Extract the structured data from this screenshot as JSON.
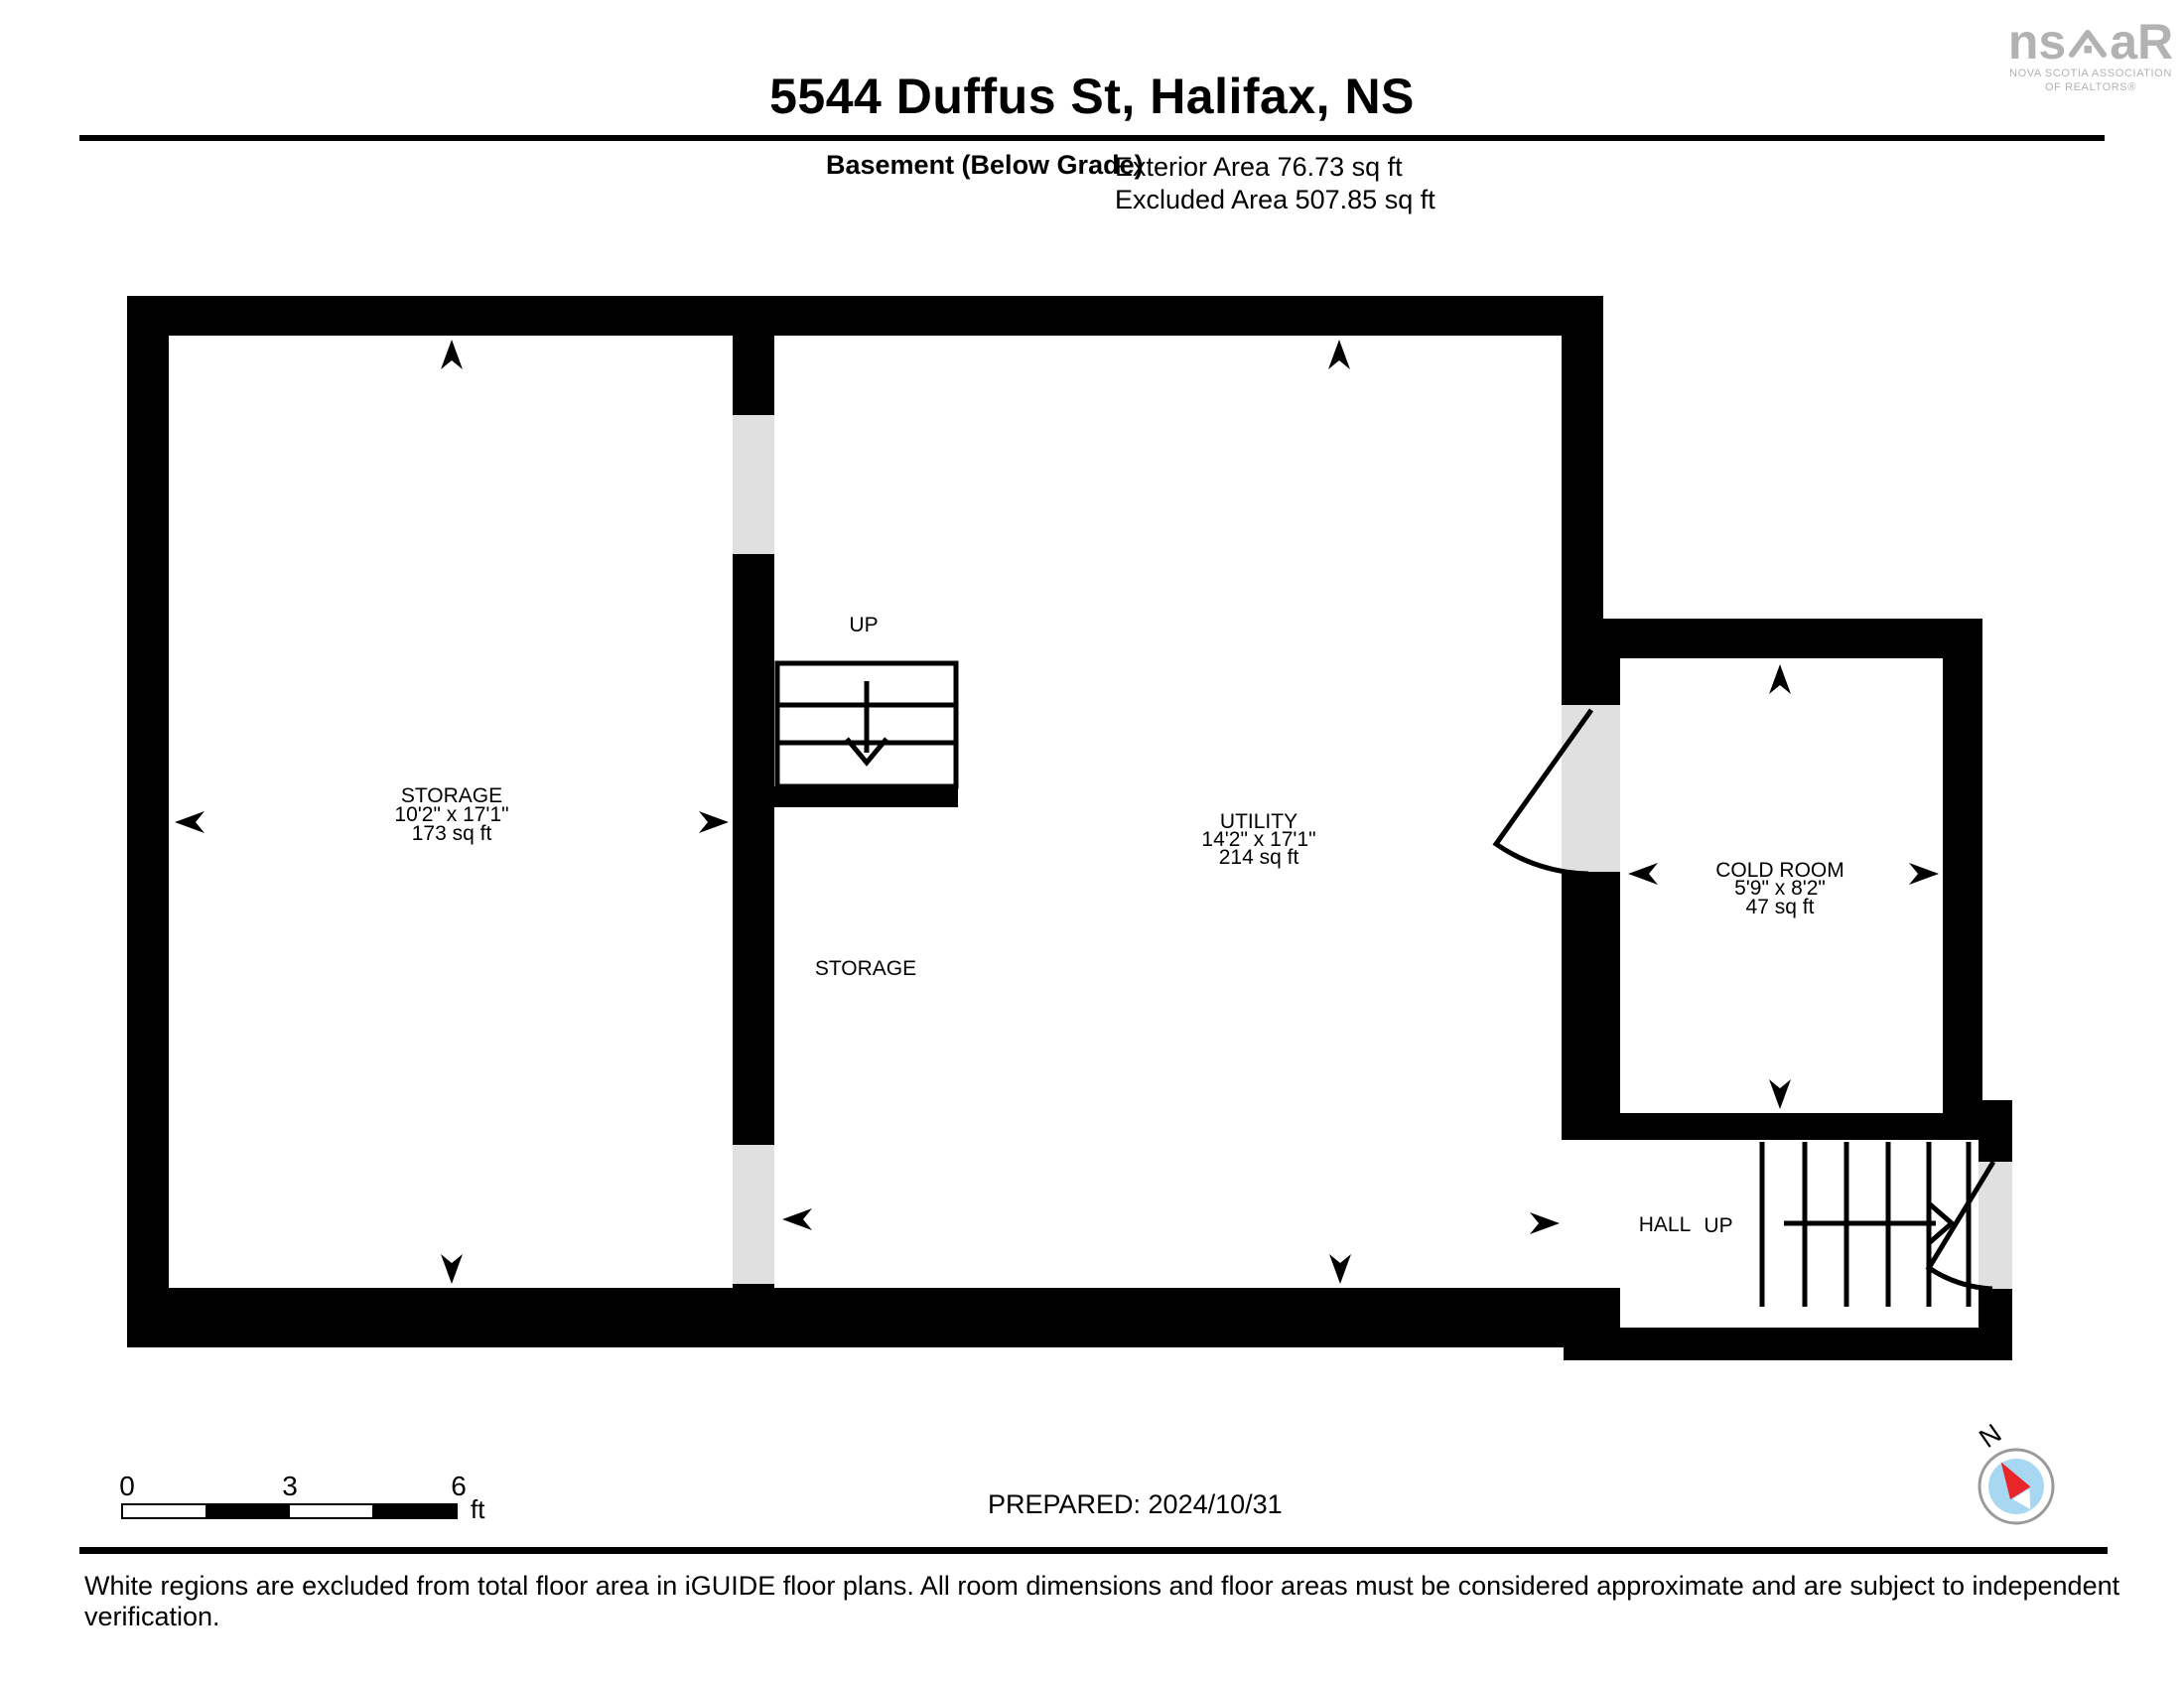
{
  "header": {
    "title": "5544 Duffus St, Halifax, NS",
    "floor_label": "Basement (Below Grade)",
    "exterior_area": "Exterior Area 76.73 sq ft",
    "excluded_area": "Excluded Area 507.85 sq ft"
  },
  "logo": {
    "brand_left": "ns",
    "brand_right": "aR",
    "tagline_line1": "NOVA SCOTIA ASSOCIATION",
    "tagline_line2": "OF REALTORS®",
    "color": "#b2b2b2"
  },
  "floor_plan": {
    "rooms": {
      "storage": {
        "name": "STORAGE",
        "dims": "10'2\" x 17'1\"",
        "area": "173 sq ft"
      },
      "utility": {
        "name": "UTILITY",
        "dims": "14'2\" x 17'1\"",
        "area": "214 sq ft"
      },
      "cold_room": {
        "name": "COLD ROOM",
        "dims": "5'9\" x 8'2\"",
        "area": "47 sq ft"
      },
      "storage_nook": {
        "name": "STORAGE"
      },
      "hall": {
        "name": "HALL"
      }
    },
    "stairs": {
      "upper_label": "UP",
      "lower_label": "UP"
    },
    "wall_color": "#000000",
    "door_color": "#e0e0e0"
  },
  "scale_bar": {
    "tick0": "0",
    "tick1": "3",
    "tick2": "6",
    "unit": "ft"
  },
  "prepared_label": "PREPARED: 2024/10/31",
  "compass": {
    "label": "N",
    "needle_red": "#e8262a",
    "dial_blue": "#a8d7f2"
  },
  "footer": {
    "disclaimer": "White regions are excluded from total floor area in iGUIDE floor plans. All room dimensions and floor areas must be considered approximate and are subject to independent verification."
  }
}
